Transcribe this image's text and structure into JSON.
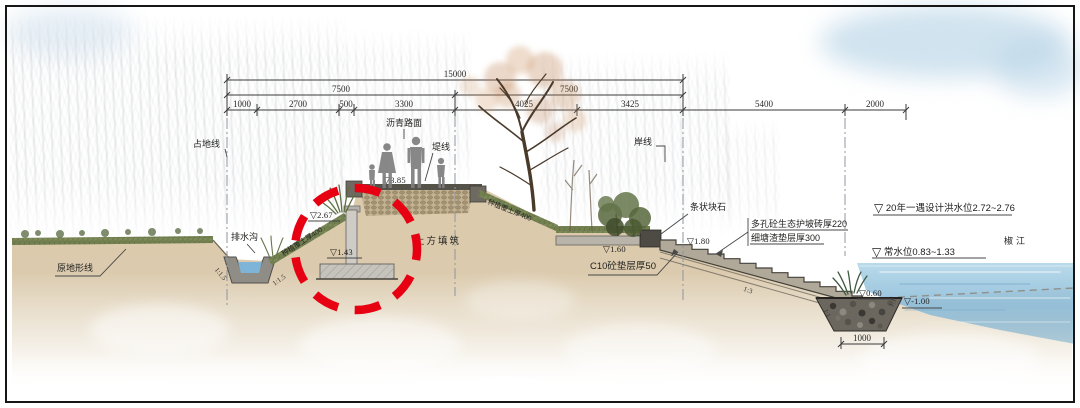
{
  "dims": {
    "total": "15000",
    "half_left": "7500",
    "half_right": "7500",
    "segments": [
      "1000",
      "2700",
      "500",
      "3300",
      "4025",
      "3425",
      "5400",
      "2000"
    ],
    "riprap_width": "1000"
  },
  "labels": {
    "occupation_line": "占地线",
    "shore_line": "岸线",
    "dike_line": "堤线",
    "asphalt_pavement": "沥青路面",
    "drainage_ditch": "排水沟",
    "original_ground_line": "原地形线",
    "earth_fill": "土方填筑",
    "planting_soil_left": "种植覆土厚400",
    "planting_soil_right": "种植覆土厚400",
    "strip_stone": "条状块石",
    "porous_brick": "多孔砼生态护坡砖厚220",
    "gravel_cushion": "细塘渣垫层厚300",
    "c10_cushion": "C10砼垫层厚50",
    "river_name": "椒江"
  },
  "water_levels": {
    "flood": "20年一遇设计洪水位2.72~2.76",
    "normal": "常水位0.83~1.33"
  },
  "marker_symbol": "▽",
  "elevations": {
    "crest": "3.85",
    "wall_top": "2.67",
    "wall_base": "1.43",
    "green_strip": "2",
    "platform": "1.60",
    "stone_top": "1.80",
    "toe": "0.60",
    "riprap_bottom": "-1.00"
  },
  "slopes": {
    "ditch_left": "1:1.5",
    "ditch_right": "1:1.5",
    "steps": "1:3",
    "riprap_left": "1:1",
    "riprap_right": "1:1"
  },
  "colors": {
    "highlight_red": "#e60012",
    "water_blue": "#8fc0dc",
    "earth_tan": "#d8c5a2",
    "vegetation_green": "#7d8a58"
  }
}
